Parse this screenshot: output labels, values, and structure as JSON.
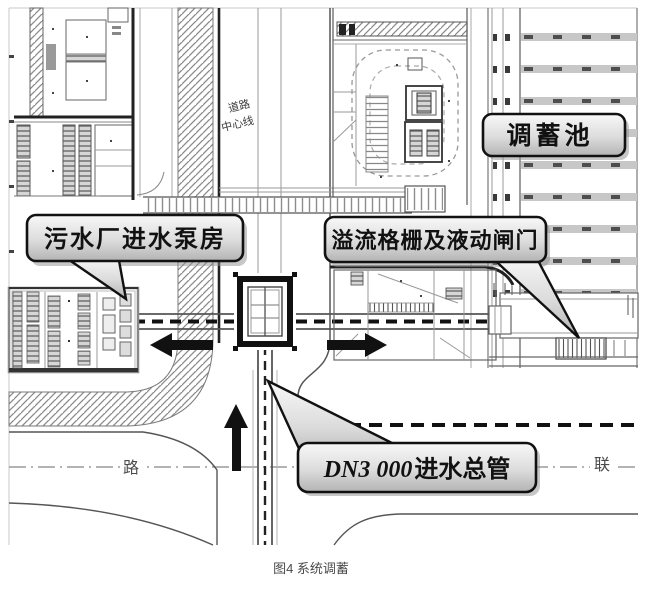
{
  "figure_caption": "图4 系统调蓄",
  "callouts": {
    "pump_house": "污水厂进水泵房",
    "storage_tank": "调蓄池",
    "overflow_gate": "溢流格栅及液动闸门",
    "inlet_main": {
      "prefix": "DN3 000",
      "suffix": "进水总管"
    }
  },
  "plan_labels": {
    "road_centerline_line1": "道路",
    "road_centerline_line2": "中心线",
    "road_name_left": "路",
    "road_name_right": "联"
  },
  "colors": {
    "line_dark": "#111111",
    "line_mid": "#555555",
    "hatch": "#8a8a8a",
    "pool_band": "#c7c7c7",
    "caption": "#4a4a4a"
  }
}
